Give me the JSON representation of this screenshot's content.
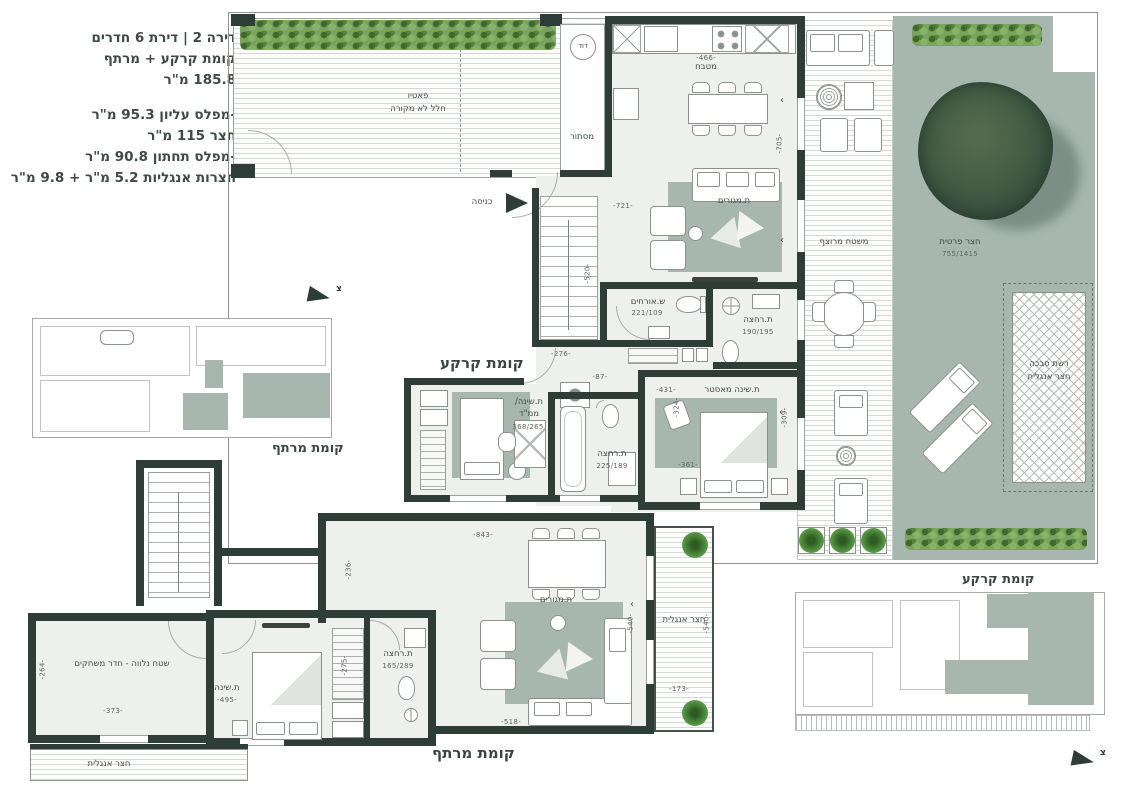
{
  "info": {
    "l1": "דירה 2 | דירת 6 חדרים",
    "l2": "קומת קרקע + מרתף",
    "l3": "185.8 מ\"ר",
    "l4": "-מפלס עליון 95.3 מ\"ר",
    "l5": "חצר 115 מ\"ר",
    "l6": "-מפלס תחתון 90.8 מ\"ר",
    "l7": "חצרות אנגליות 5.2 מ\"ר + 9.8 מ\"ר"
  },
  "ground": {
    "title": "קומת קרקע",
    "patio_name": "פאטיו",
    "patio_sub": "חלל לא מקורה",
    "entry": "כניסה",
    "boiler": "דוד",
    "screen": "מסתור",
    "kitchen_label": "מטבח",
    "kitchen_dim": "-466-",
    "dining_dim": "-705-",
    "living_label": "ת.מגורים",
    "living_dim": "-721-",
    "stairs_dim": "-520-",
    "dim_276": "-276-",
    "dim_87": "-87-",
    "dim_64": "-64-",
    "guest_wc_label": "ש.אורחים",
    "guest_wc_size": "221/109",
    "bath1_label": "ת.רחצה",
    "bath1_size": "190/195",
    "bath2_label": "ת.רחצה",
    "bath2_size": "225/189",
    "mamad_l1": "ת.שינה/",
    "mamad_l2": "ממ\"ד",
    "mamad_size": "368/265",
    "master_label": "ת.שינה מאסטר",
    "master_w": "-431-",
    "master_d1": "-324-",
    "master_d2": "-361-",
    "master_d3": "-309-",
    "deck_label": "משטח מרוצף",
    "garden_label": "חצר פרטית",
    "garden_size": "755/1415",
    "trellis_l1": "רשת סבכה",
    "trellis_l2": "חצר אנגלית"
  },
  "basement": {
    "title": "קומת מרתף",
    "living_label": "ת.מגורים",
    "dim_843": "-843-",
    "dim_236": "-236-",
    "dim_540": "-540-",
    "dim_518": "-518-",
    "court_label": "חצר אנגלית",
    "dim_173": "-173-",
    "dim_540b": "-540-",
    "bedroom_label": "ת.שינה",
    "dim_495": "-495-",
    "dim_275": "-275-",
    "bath_label": "ת.רחצה",
    "bath_size": "165/289",
    "game_label": "שטח נלווה - חדר משחקים",
    "dim_373": "-373-",
    "dim_264": "-264-",
    "court_left_label": "חצר אנגלית"
  },
  "keyplans": {
    "basement_title": "קומת מרתף",
    "ground_title": "קומת קרקע",
    "north_letter": "צ"
  },
  "marks": {
    "chevron": "›"
  },
  "colors": {
    "wall": "#2f3d38",
    "floor": "#eef0ed",
    "sage": "#a7b7b0",
    "hedge_green": "#5f8f4b",
    "text": "#3f4b45"
  }
}
